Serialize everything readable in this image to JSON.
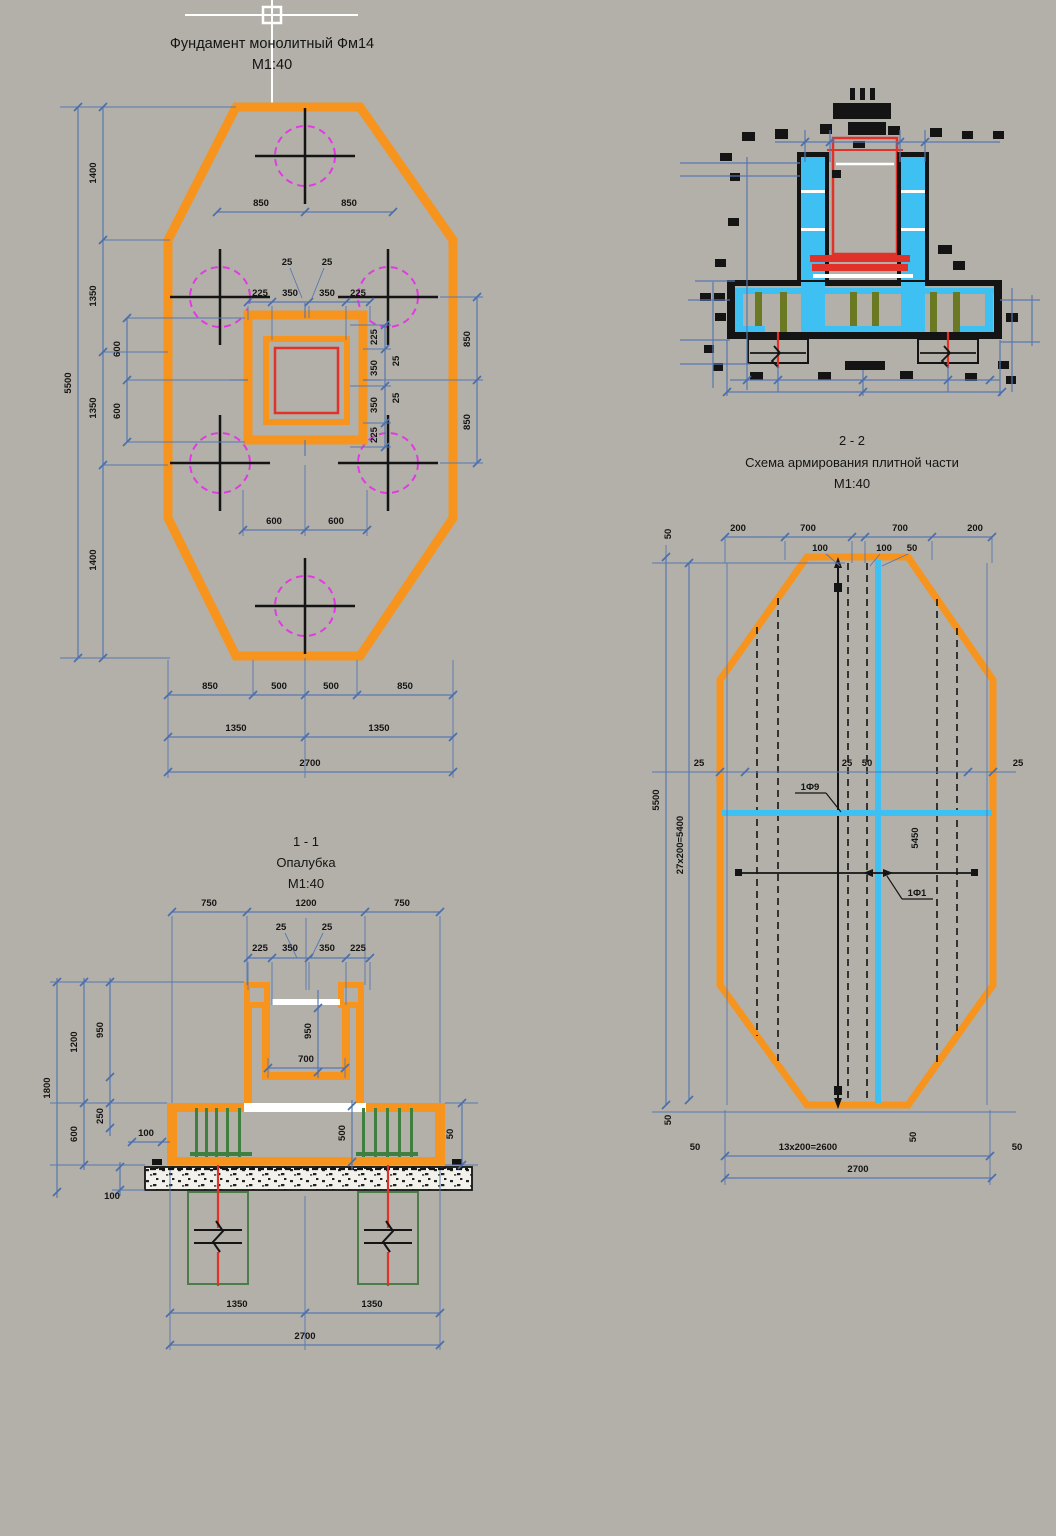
{
  "titles": {
    "plan": {
      "l1": "Фундамент монолитный Фм14",
      "l2": "М1:40"
    },
    "s11": {
      "l1": "1 - 1",
      "l2": "Опалубка",
      "l3": "М1:40"
    },
    "s22": {
      "l1": "2 - 2",
      "l2": "Схема армирования плитной части",
      "l3": "М1:40"
    }
  },
  "plan": {
    "top": [
      "850",
      "850"
    ],
    "flags": [
      "25",
      "25"
    ],
    "row": [
      "225",
      "350",
      "350",
      "225"
    ],
    "rrow": [
      "225",
      "350",
      "350",
      "225"
    ],
    "rflags": [
      "25",
      "25"
    ],
    "router": [
      "850",
      "850"
    ],
    "lchain": [
      "1400",
      "1350",
      "1350",
      "1400"
    ],
    "l600": [
      "600",
      "600"
    ],
    "total_v": "5500",
    "mid": [
      "600",
      "600"
    ],
    "b1": [
      "850",
      "500",
      "500",
      "850"
    ],
    "b2": [
      "1350",
      "1350"
    ],
    "total_h": "2700"
  },
  "s11": {
    "top": [
      "750",
      "1200",
      "750"
    ],
    "flags": [
      "25",
      "25"
    ],
    "row": [
      "225",
      "350",
      "350",
      "225"
    ],
    "left": [
      "1800",
      "1200",
      "950",
      "600",
      "250"
    ],
    "h100": [
      "100",
      "100"
    ],
    "c950": "950",
    "c700": "700",
    "r500": "500",
    "r50": "50",
    "b2": [
      "1350",
      "1350"
    ],
    "total_h": "2700"
  },
  "rplan": {
    "top": [
      "200",
      "700",
      "700",
      "200"
    ],
    "flags": [
      "100",
      "100",
      "50"
    ],
    "tl": "50",
    "total_v": "5500",
    "chain_v": "27x200=5400",
    "e25": [
      "25",
      "25"
    ],
    "c": [
      "25",
      "50"
    ],
    "inner": "5450",
    "marks": [
      "1Ф9",
      "1Ф1"
    ],
    "edge50": [
      "50",
      "50",
      "50",
      "50"
    ],
    "spacing": "13x200=2600",
    "total_h": "2700"
  },
  "colors": {
    "background": "#b2b0a8",
    "formwork_orange": "#f7941e",
    "dimension_blue": "#5878b2",
    "pile_magenta": "#e23ae2",
    "column_red": "#e03228",
    "rebar_cyan": "#3ec1f2",
    "rebar_olive": "#6b7a22",
    "formwork_green": "#3f8040"
  }
}
